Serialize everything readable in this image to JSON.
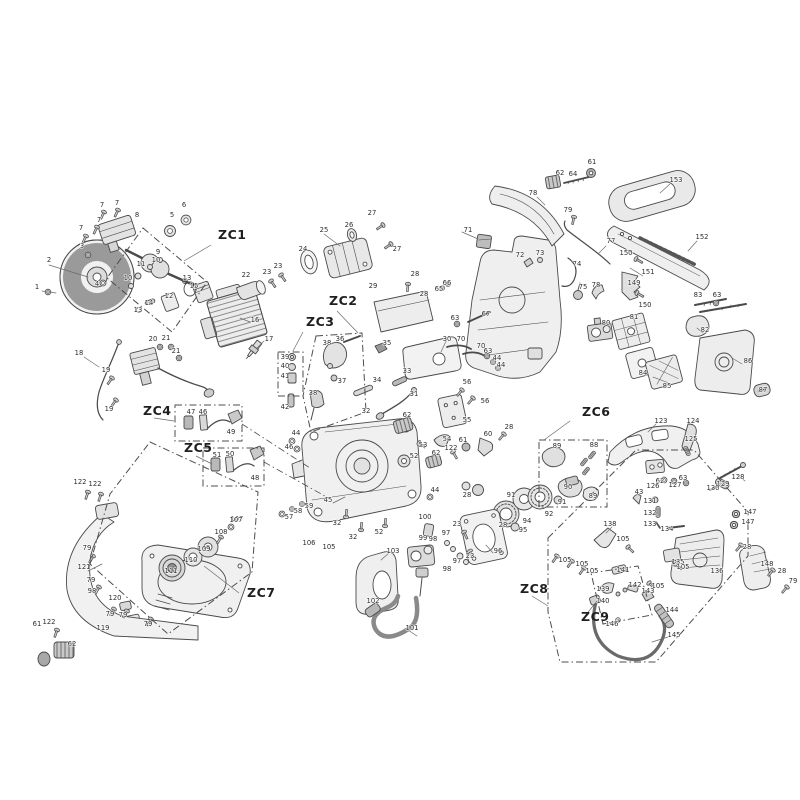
{
  "diagram": {
    "type": "exploded-parts-diagram",
    "colors": {
      "background": "#ffffff",
      "line": "#4a4a4a",
      "label": "#2e2e2e",
      "zone_line": "#4d4d4d",
      "fill_light": "#ededed",
      "fill_mid": "#d6d6d6",
      "fill_dark": "#b5b5b5"
    },
    "zones": [
      {
        "id": "ZC1",
        "x": 218,
        "y": 239,
        "box": "143,228 207,282 172,332 107,278",
        "leader": [
          211,
          245,
          184,
          261
        ]
      },
      {
        "id": "ZC2",
        "x": 329,
        "y": 305,
        "box": "316,336 362,333 366,412 311,432 303,396",
        "leader": [
          337,
          311,
          358,
          333
        ]
      },
      {
        "id": "ZC3",
        "x": 306,
        "y": 326,
        "box": "278,352 303,352 303,396 278,396",
        "leader": [
          303,
          332,
          293,
          351
        ]
      },
      {
        "id": "ZC4",
        "x": 143,
        "y": 415,
        "box": "175,405 242,405 242,441 175,441",
        "leader": [
          154,
          418,
          174,
          421
        ]
      },
      {
        "id": "ZC5",
        "x": 184,
        "y": 452,
        "box": "203,448 264,448 264,486 203,486",
        "leader": [
          196,
          456,
          212,
          464
        ]
      },
      {
        "id": "ZC6",
        "x": 582,
        "y": 416,
        "box": "539,440 607,440 607,507 539,507",
        "leader": [
          570,
          421,
          544,
          440
        ]
      },
      {
        "id": "ZC7",
        "x": 247,
        "y": 597,
        "box": "150,442 258,492 252,572 168,634 90,564 110,494",
        "leader": [
          239,
          593,
          204,
          566
        ]
      },
      {
        "id": "ZC8",
        "x": 520,
        "y": 593,
        "box": "548,538 636,450 694,450 748,512 748,556 656,662 560,662 548,612",
        "leader": [
          532,
          596,
          548,
          606
        ]
      },
      {
        "id": "ZC9",
        "x": 581,
        "y": 621,
        "box": "591,573 638,566 652,615 603,624",
        "leader": [
          585,
          616,
          597,
          601
        ]
      }
    ],
    "links": [
      [
        242,
        424,
        310,
        468
      ],
      [
        264,
        462,
        332,
        500
      ]
    ],
    "labels": [
      [
        "7",
        102,
        207
      ],
      [
        "7",
        117,
        205
      ],
      [
        "7",
        99,
        222
      ],
      [
        "7",
        81,
        230
      ],
      [
        "8",
        137,
        217
      ],
      [
        "6",
        184,
        207
      ],
      [
        "5",
        172,
        217
      ],
      [
        "3",
        82,
        248
      ],
      [
        "2",
        49,
        262
      ],
      [
        "1",
        37,
        289
      ],
      [
        "4",
        97,
        286
      ],
      [
        "9",
        158,
        254
      ],
      [
        "10",
        156,
        262
      ],
      [
        "11",
        141,
        266
      ],
      [
        "10",
        128,
        280
      ],
      [
        "13",
        187,
        280
      ],
      [
        "15",
        194,
        288
      ],
      [
        "12",
        169,
        298
      ],
      [
        "14",
        149,
        305
      ],
      [
        "13",
        138,
        312
      ],
      [
        "16",
        255,
        322
      ],
      [
        "17",
        269,
        341
      ],
      [
        "22",
        246,
        277
      ],
      [
        "23",
        267,
        274
      ],
      [
        "23",
        278,
        268
      ],
      [
        "20",
        153,
        341
      ],
      [
        "21",
        166,
        340
      ],
      [
        "21",
        176,
        353
      ],
      [
        "18",
        79,
        355
      ],
      [
        "19",
        106,
        372
      ],
      [
        "19",
        109,
        411
      ],
      [
        "24",
        303,
        251
      ],
      [
        "25",
        324,
        232
      ],
      [
        "26",
        349,
        227
      ],
      [
        "27",
        372,
        215
      ],
      [
        "27",
        397,
        251
      ],
      [
        "28",
        415,
        276
      ],
      [
        "29",
        373,
        288
      ],
      [
        "28",
        424,
        296
      ],
      [
        "30",
        447,
        341
      ],
      [
        "65",
        439,
        291
      ],
      [
        "66",
        447,
        285
      ],
      [
        "63",
        455,
        320
      ],
      [
        "67",
        486,
        316
      ],
      [
        "70",
        461,
        341
      ],
      [
        "70",
        481,
        348
      ],
      [
        "63",
        488,
        353
      ],
      [
        "44",
        497,
        360
      ],
      [
        "44",
        501,
        367
      ],
      [
        "71",
        468,
        232
      ],
      [
        "62",
        560,
        175
      ],
      [
        "64",
        573,
        176
      ],
      [
        "61",
        592,
        164
      ],
      [
        "78",
        533,
        195
      ],
      [
        "79",
        568,
        212
      ],
      [
        "77",
        611,
        243
      ],
      [
        "153",
        676,
        182
      ],
      [
        "152",
        702,
        239
      ],
      [
        "151",
        648,
        274
      ],
      [
        "150",
        626,
        255
      ],
      [
        "150",
        645,
        307
      ],
      [
        "149",
        634,
        285
      ],
      [
        "72",
        520,
        257
      ],
      [
        "73",
        540,
        255
      ],
      [
        "74",
        577,
        266
      ],
      [
        "75",
        583,
        289
      ],
      [
        "78",
        596,
        287
      ],
      [
        "80",
        606,
        325
      ],
      [
        "81",
        634,
        319
      ],
      [
        "82",
        705,
        332
      ],
      [
        "83",
        698,
        297
      ],
      [
        "63",
        717,
        297
      ],
      [
        "84",
        643,
        375
      ],
      [
        "85",
        667,
        388
      ],
      [
        "86",
        748,
        363
      ],
      [
        "87",
        763,
        392
      ],
      [
        "35",
        387,
        345
      ],
      [
        "36",
        340,
        341
      ],
      [
        "38",
        327,
        345
      ],
      [
        "37",
        342,
        383
      ],
      [
        "38",
        313,
        395
      ],
      [
        "33",
        407,
        373
      ],
      [
        "34",
        377,
        382
      ],
      [
        "31",
        414,
        396
      ],
      [
        "32",
        366,
        413
      ],
      [
        "39",
        285,
        359
      ],
      [
        "40",
        285,
        368
      ],
      [
        "41",
        285,
        378
      ],
      [
        "42",
        285,
        409
      ],
      [
        "47",
        191,
        414
      ],
      [
        "46",
        203,
        414
      ],
      [
        "49",
        231,
        434
      ],
      [
        "51",
        217,
        457
      ],
      [
        "50",
        230,
        456
      ],
      [
        "48",
        255,
        480
      ],
      [
        "44",
        296,
        435
      ],
      [
        "46",
        289,
        449
      ],
      [
        "57",
        289,
        519
      ],
      [
        "58",
        298,
        513
      ],
      [
        "59",
        309,
        508
      ],
      [
        "107",
        237,
        521
      ],
      [
        "62",
        407,
        417
      ],
      [
        "52",
        414,
        458
      ],
      [
        "53",
        423,
        447
      ],
      [
        "54",
        447,
        441
      ],
      [
        "55",
        467,
        422
      ],
      [
        "56",
        467,
        384
      ],
      [
        "56",
        485,
        403
      ],
      [
        "60",
        488,
        436
      ],
      [
        "61",
        463,
        442
      ],
      [
        "122",
        451,
        450
      ],
      [
        "62",
        436,
        455
      ],
      [
        "28",
        509,
        429
      ],
      [
        "45",
        328,
        502
      ],
      [
        "32",
        337,
        525
      ],
      [
        "32",
        353,
        539
      ],
      [
        "52",
        379,
        534
      ],
      [
        "44",
        435,
        492
      ],
      [
        "28",
        467,
        497
      ],
      [
        "91",
        511,
        497
      ],
      [
        "94",
        527,
        523
      ],
      [
        "95",
        523,
        532
      ],
      [
        "96",
        498,
        553
      ],
      [
        "23",
        457,
        526
      ],
      [
        "97",
        446,
        535
      ],
      [
        "23",
        470,
        558
      ],
      [
        "97",
        457,
        563
      ],
      [
        "98",
        447,
        571
      ],
      [
        "98",
        433,
        541
      ],
      [
        "99",
        423,
        540
      ],
      [
        "100",
        425,
        519
      ],
      [
        "103",
        393,
        553
      ],
      [
        "105",
        329,
        549
      ],
      [
        "106",
        309,
        545
      ],
      [
        "101",
        412,
        630
      ],
      [
        "102",
        373,
        603
      ],
      [
        "28",
        503,
        527
      ],
      [
        "88",
        594,
        447
      ],
      [
        "89",
        557,
        448
      ],
      [
        "90",
        568,
        489
      ],
      [
        "89",
        593,
        498
      ],
      [
        "91",
        562,
        504
      ],
      [
        "92",
        549,
        516
      ],
      [
        "123",
        661,
        423
      ],
      [
        "124",
        693,
        423
      ],
      [
        "125",
        691,
        441
      ],
      [
        "63",
        683,
        480
      ],
      [
        "62",
        660,
        483
      ],
      [
        "126",
        653,
        488
      ],
      [
        "127",
        675,
        487
      ],
      [
        "43",
        639,
        494
      ],
      [
        "128",
        738,
        479
      ],
      [
        "129",
        723,
        486
      ],
      [
        "130",
        713,
        490
      ],
      [
        "131",
        650,
        503
      ],
      [
        "132",
        650,
        515
      ],
      [
        "133",
        650,
        526
      ],
      [
        "134",
        667,
        531
      ],
      [
        "135",
        678,
        564
      ],
      [
        "136",
        717,
        573
      ],
      [
        "138",
        610,
        526
      ],
      [
        "105",
        623,
        541
      ],
      [
        "141",
        623,
        572
      ],
      [
        "147",
        750,
        514
      ],
      [
        "147",
        748,
        524
      ],
      [
        "28",
        747,
        549
      ],
      [
        "148",
        767,
        566
      ],
      [
        "28",
        782,
        573
      ],
      [
        "79",
        793,
        583
      ],
      [
        "105",
        565,
        562
      ],
      [
        "105",
        582,
        566
      ],
      [
        "105",
        592,
        573
      ],
      [
        "105",
        658,
        588
      ],
      [
        "105",
        683,
        569
      ],
      [
        "139",
        603,
        591
      ],
      [
        "142",
        635,
        587
      ],
      [
        "143",
        648,
        593
      ],
      [
        "140",
        603,
        603
      ],
      [
        "146",
        612,
        626
      ],
      [
        "144",
        672,
        612
      ],
      [
        "145",
        674,
        637
      ],
      [
        "122",
        80,
        484
      ],
      [
        "122",
        95,
        486
      ],
      [
        "79",
        87,
        550
      ],
      [
        "121",
        84,
        569
      ],
      [
        "79",
        91,
        582
      ],
      [
        "98",
        92,
        593
      ],
      [
        "120",
        115,
        600
      ],
      [
        "79",
        110,
        616
      ],
      [
        "79",
        123,
        617
      ],
      [
        "119",
        103,
        630
      ],
      [
        "79",
        148,
        626
      ],
      [
        "61",
        37,
        626
      ],
      [
        "122",
        49,
        624
      ],
      [
        "62",
        72,
        646
      ],
      [
        "111",
        171,
        573
      ],
      [
        "110",
        191,
        562
      ],
      [
        "109",
        204,
        551
      ],
      [
        "108",
        221,
        534
      ],
      [
        "107",
        236,
        522
      ]
    ]
  }
}
